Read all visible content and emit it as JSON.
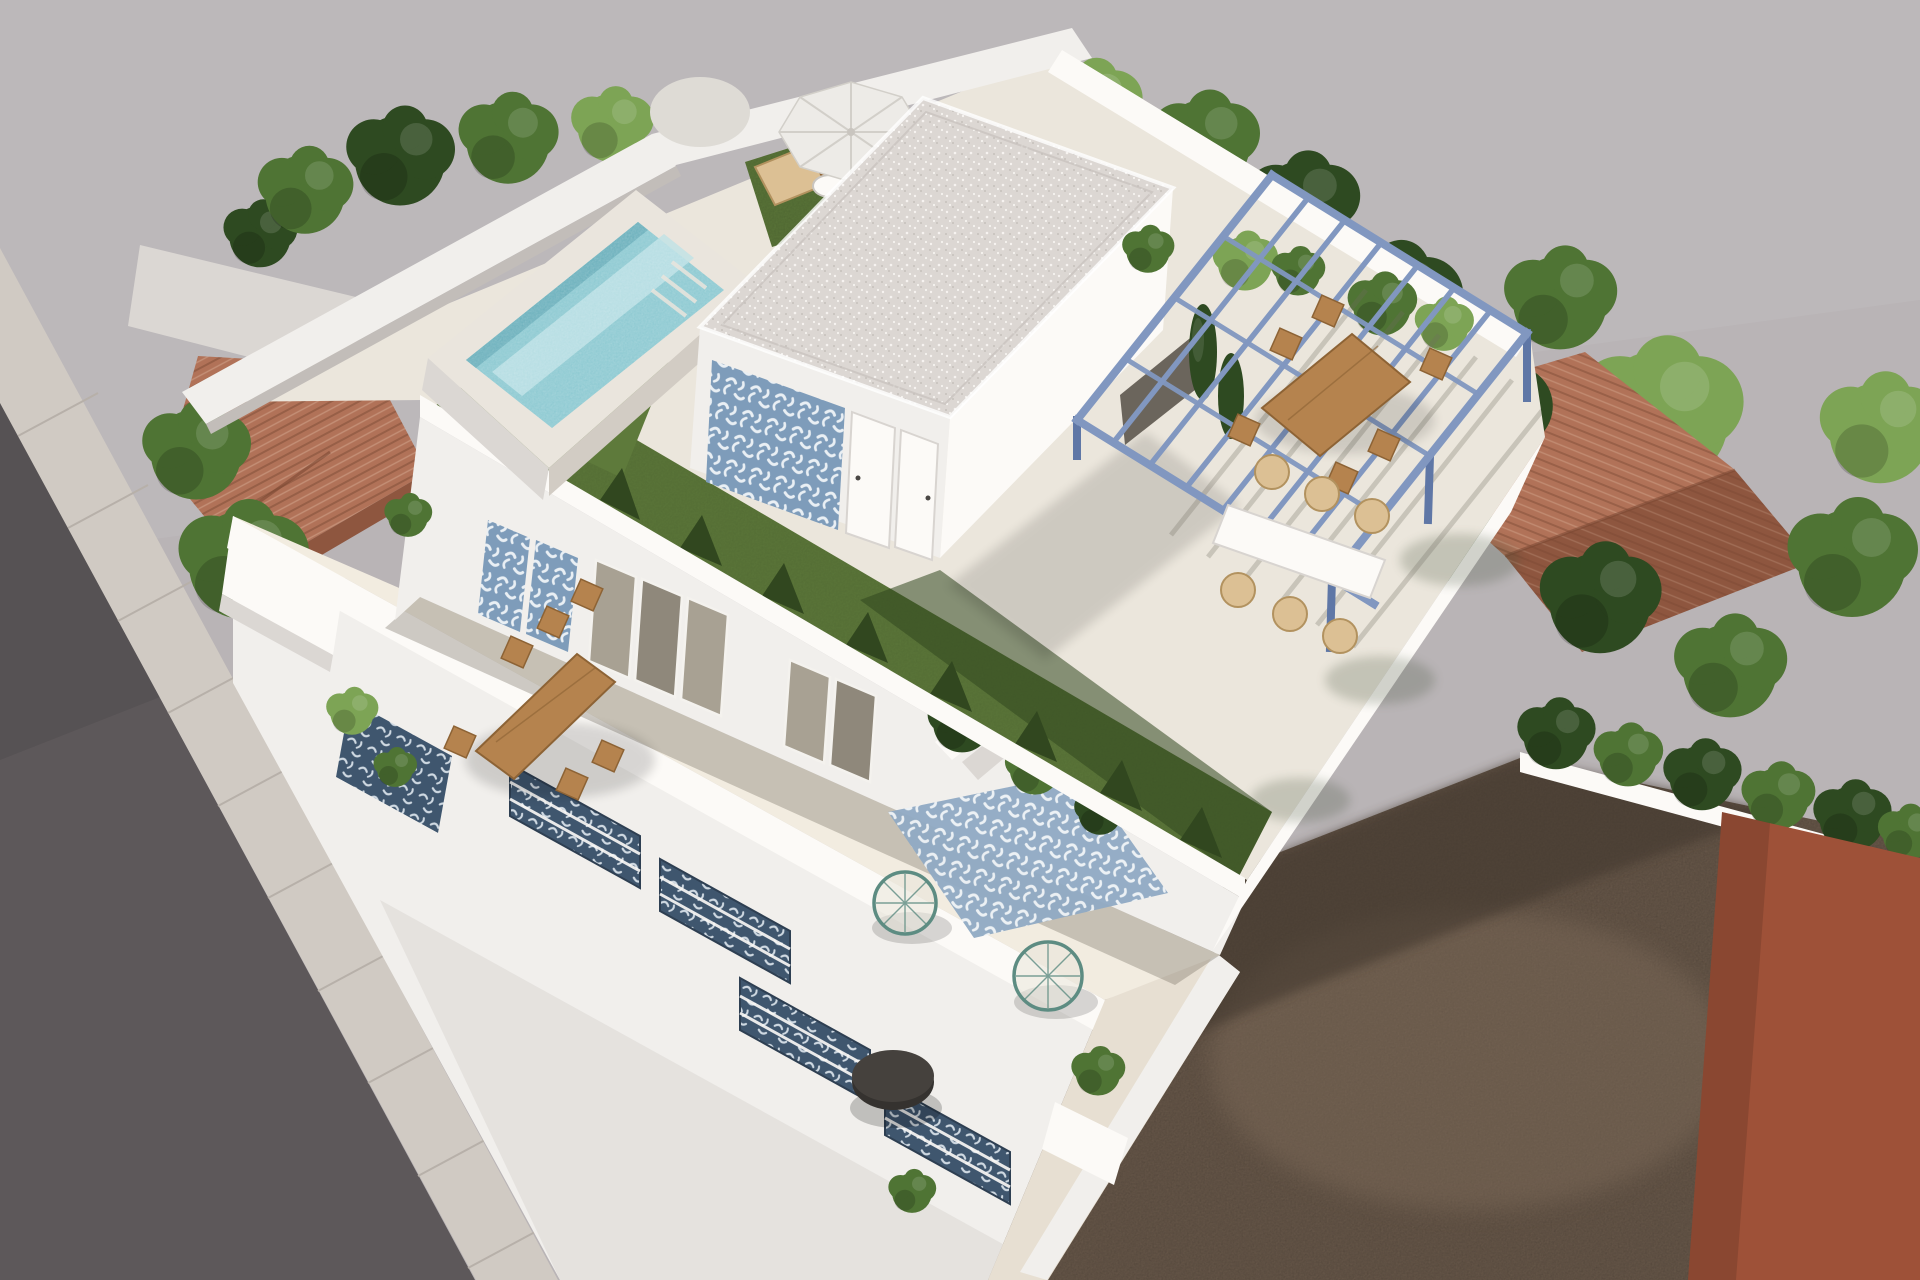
{
  "meta": {
    "type": "architectural-3d-render",
    "description": "Aerial 3D architectural rendering of a modern two-storey white villa with a rooftop terrace: elevated turquoise plunge pool, artificial lawn, white pool-house volume with blue patterned tile accent wall, steel-blue pergola over an outdoor dining set, sun loungers under a white parasol, a first-floor terrace with wooden dining table, wire lounge chairs and patterned tile rug, street with sidewalk at lower left, neighbouring red clay-tile roofs and trees on both sides, and an empty brown dirt plot with a rust-coloured neighbouring building at lower right.",
    "visible_text": []
  },
  "palette": {
    "bg": "#b9b4b6",
    "bgLight": "#c0bbbd",
    "road": "#5d585a",
    "roadDark": "#504c4e",
    "sidewalk": "#d0cac3",
    "sidewalkLine": "#b7b0a9",
    "wall": "#f1efec",
    "wallLit": "#fcfaf7",
    "wallShade": "#dbd7d3",
    "wallDark": "#c2bdb9",
    "floor": "#e7dfd2",
    "floorLit": "#f2ece0",
    "floorShade": "#cbc4b8",
    "roofFloor": "#ebe6dc",
    "speckleBase": "#dcd7d3",
    "speckleDot": "#f6f3f0",
    "lawn": "#5e7a3b",
    "lawnLit": "#6f8c46",
    "lawnDark": "#31471f",
    "shrubDark": "#24381548",
    "water": "#82c4cd",
    "waterLight": "#bce2e5",
    "waterDark": "#5ea9b6",
    "rim": "#eae5dd",
    "plinthSide": "#d2ccc4",
    "tileBlue": "#7e9cba",
    "tileWhite": "#e9eff4",
    "tileDarkBg": "#3f566e",
    "tileDarkFg": "#cfd9e2",
    "pergola": "#8197c0",
    "pergolaDark": "#5f77a6",
    "wood": "#b5834e",
    "woodDark": "#8d6335",
    "wicker": "#dcc094",
    "wickerDark": "#b2925f",
    "treeDark": "#2e4a21",
    "treeMid": "#4f7434",
    "treeLight": "#7da455",
    "roofRed": "#b17258",
    "roofRedDark": "#8e563f",
    "dirt": "#6e5d4e",
    "dirtLight": "#83705d",
    "dirtDark": "#43382f",
    "rust": "#9e5138",
    "umbrella": "#edebe7",
    "umbrellaShade": "#dedbd5",
    "glass": "#a8a193",
    "black": "#35322f"
  },
  "scene": {
    "objects": [
      {
        "name": "main-villa",
        "description": "modern white two-storey villa seen from above at an angle"
      },
      {
        "name": "rooftop-pool",
        "description": "raised rectangular plunge pool with turquoise mosaic water and corner steps"
      },
      {
        "name": "rooftop-lawn",
        "description": "green artificial lawn band wrapping the roof terrace"
      },
      {
        "name": "pool-house",
        "description": "white rooftop volume with speckled flat roof, blue patterned tile accent wall and two white doors"
      },
      {
        "name": "pergola",
        "description": "steel-blue open pergola frame over rooftop dining area"
      },
      {
        "name": "rooftop-dining-set",
        "description": "wooden dining table with chairs and wicker armchairs under the pergola"
      },
      {
        "name": "parasol-corner",
        "description": "white parasol with wooden sun loungers and side table on turf patch"
      },
      {
        "name": "first-floor-terrace",
        "description": "long terrace with wooden dining table, tile rug, wire lounge chairs and round black table"
      },
      {
        "name": "street",
        "description": "asphalt road and pale concrete sidewalk at lower left"
      },
      {
        "name": "neighbour-roof-left",
        "description": "red clay tile roof of neighbouring house on the left"
      },
      {
        "name": "neighbour-roof-right",
        "description": "red clay tile hip roof among trees on the right"
      },
      {
        "name": "dirt-plot",
        "description": "empty brown dirt plot at lower right"
      },
      {
        "name": "rust-building",
        "description": "rust-coloured neighbouring building at bottom right corner"
      },
      {
        "name": "trees",
        "description": "green trees and hedges surrounding the plot"
      }
    ]
  }
}
